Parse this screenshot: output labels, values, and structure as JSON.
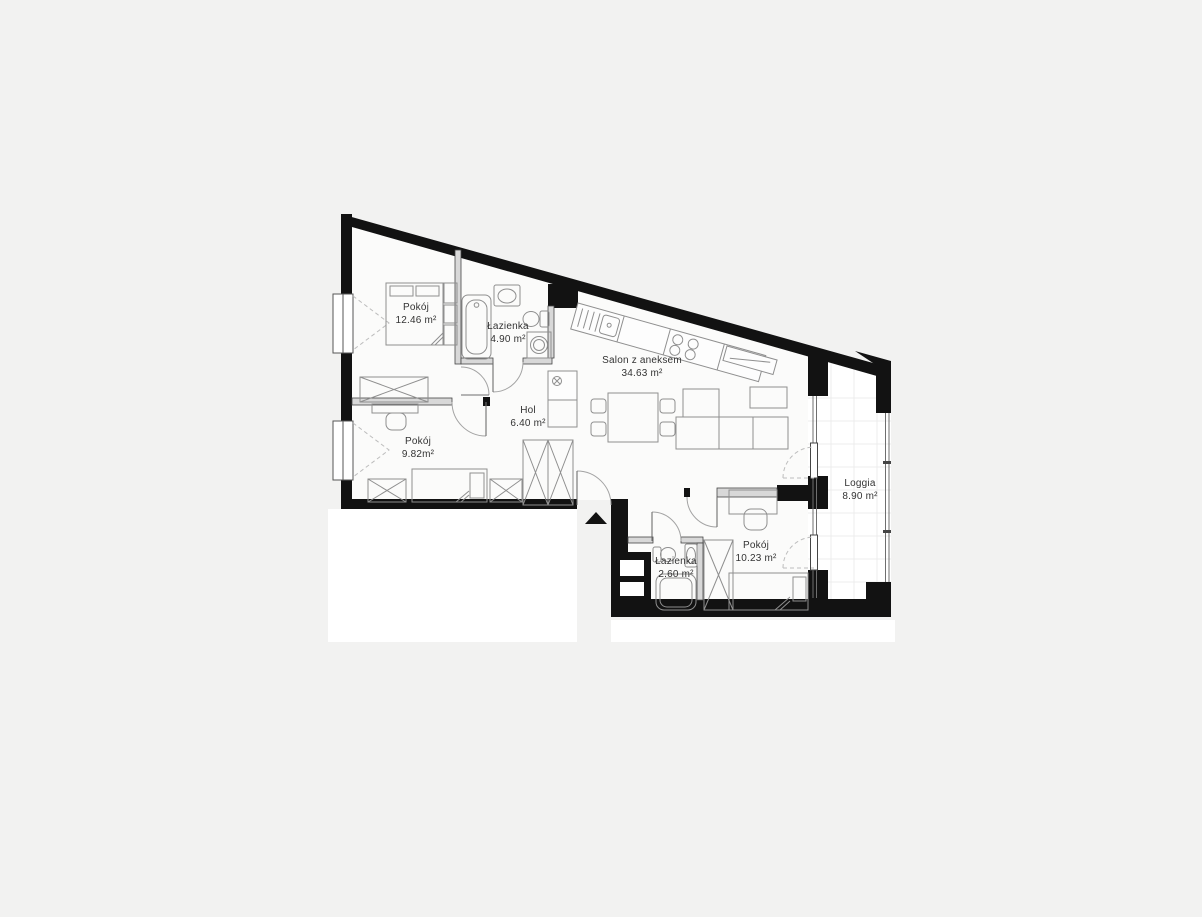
{
  "plan": {
    "type": "apartment-floor-plan",
    "rooms": [
      {
        "id": "pokoj-1",
        "name": "Pokój",
        "area": "12.46 m²",
        "x": 416,
        "y": 310
      },
      {
        "id": "lazienka-1",
        "name": "Łazienka",
        "area": "4.90 m²",
        "x": 508,
        "y": 329
      },
      {
        "id": "salon",
        "name": "Salon z aneksem",
        "area": "34.63 m²",
        "x": 642,
        "y": 363
      },
      {
        "id": "hol",
        "name": "Hol",
        "area": "6.40 m²",
        "x": 528,
        "y": 413
      },
      {
        "id": "pokoj-2",
        "name": "Pokój",
        "area": "9.82m²",
        "x": 418,
        "y": 444
      },
      {
        "id": "lazienka-2",
        "name": "Łazienka",
        "area": "2.60 m²",
        "x": 676,
        "y": 564
      },
      {
        "id": "pokoj-3",
        "name": "Pokój",
        "area": "10.23 m²",
        "x": 756,
        "y": 548
      },
      {
        "id": "loggia",
        "name": "Loggia",
        "area": "8.90 m²",
        "x": 860,
        "y": 486
      }
    ],
    "entrance_marker": "triangle-up",
    "colors": {
      "background": "#f2f2f1",
      "wall": "#121212",
      "floor": "#fbfbfa",
      "loggia_floor": "#ffffff",
      "loggia_grid": "#ececec",
      "furniture_line": "#8f8f8f",
      "label_text": "#333333"
    }
  }
}
